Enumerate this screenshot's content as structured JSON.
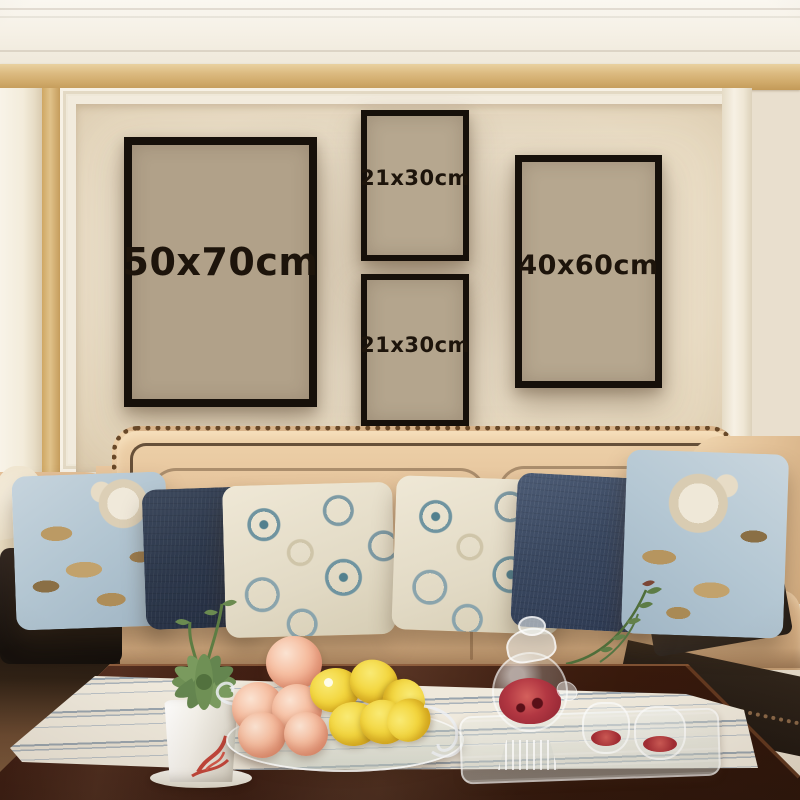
{
  "scene": {
    "type": "photograph",
    "description": "Living room wall-art size mockup: four black poster frames labelled with print sizes hang on a cream panelled wall with gold trim above a beige nailhead-trim sofa; a dark wood coffee table in front holds a succulent in a white pot, a glass dish of peaches and lemons, and a glass teapot set with red tea on a striped runner"
  },
  "frames": [
    {
      "id": "frame-50x70",
      "label": "50x70cm"
    },
    {
      "id": "frame-21x30-top",
      "label": "21x30cm"
    },
    {
      "id": "frame-21x30-bottom",
      "label": "21x30cm"
    },
    {
      "id": "frame-40x60",
      "label": "40x60cm"
    }
  ],
  "colors": {
    "frame_border": "#16100a",
    "frame_matte": "#b3a48c",
    "label_text": "#1d140b",
    "wall_panel": "#ece0cb",
    "gold_trim": "#d8b77c",
    "crown_molding": "#f6f1e7",
    "sofa_tan": "#ddb88f",
    "nailhead": "#684828",
    "pillow_navy": "#39475f",
    "pillow_blue_floral": "#b5c7d2",
    "pillow_cream": "#e8e1ce",
    "table_wood": "#532a1b",
    "runner_cream": "#efe9dc",
    "runner_stripe": "#9aa5ae",
    "lemon_yellow": "#f0ce39",
    "peach_pink": "#f3a98c",
    "tea_red": "#a93239",
    "succulent_green": "#6f9055"
  },
  "objects": [
    "crown molding",
    "gold trim band",
    "panelled wall",
    "four black poster frames",
    "beige sofa with nailhead trim",
    "blue floral pillows",
    "navy pillows",
    "embroidered cream pillows",
    "succulent in white pot",
    "glass dish with peaches and lemons",
    "glass teapot with red tea",
    "two glass teacups",
    "striped table runner",
    "dark wood coffee table"
  ]
}
